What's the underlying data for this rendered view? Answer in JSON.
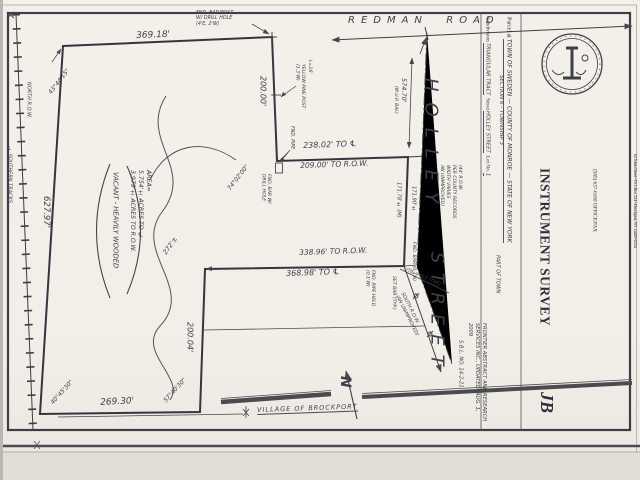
{
  "form": {
    "parcel_at_label": "Parcel at ",
    "municipality": "TOWN OF SWEDEN — COUNTY OF MONROE — STATE OF NEW YORK",
    "section_township": "SECTION 6 - TOWNSHIP 3",
    "subdivision_label": "Subdivision ",
    "subdivision": "TRIANGULAR TRACT",
    "street_label": "  Street ",
    "street": "HOLLEY STREET",
    "part_of_town": "PART OF TOWN",
    "lot_label": "  Lot No. ",
    "lot": "1",
    "abstract_note": "FRONTIER ABSTRACT AND RESEARCH\nSERVICES INC., UPDATED: AUG. 1,\n2009",
    "sbl_note": "S.B.L. NO. 14-2-21"
  },
  "title_block": {
    "firm": "A.J. BAREA-PLS",
    "profession": "Professional Land Surveyor",
    "address": "62 Main Street • P.O. Box 224 • Brockport, NY 14420-0224",
    "phone": "(585) 637-6180 OFFICE/FAX",
    "document_type": "INSTRUMENT SURVEY",
    "monogram": "JB"
  },
  "drawing": {
    "roads": {
      "redman_road": "REDMAN  ROAD",
      "holley_upper": "HOLLEY",
      "holley_lower": "STREET",
      "holley_row_note": "(44' R.O.W.\nPER COUNTY RECORDS\nWIDTH VARIES\nAN UNIMPROVED)",
      "holley_cl_dim": "574.70'",
      "holley_cl_dim_note": "(M.U.P. BAL)",
      "south_row_note": "SOUTH R.O.W.\n(AN UNIMPROVED)",
      "util_pole_note": "UTIL. POLE (TYP.)",
      "village_line": "VILLAGE OF BROCKPORT"
    },
    "railroad": {
      "centerline_label": "℄ SOUTHERN TRACKS",
      "row_label": "NORTH R.O.W."
    },
    "north_arrow": "N",
    "dimensions": {
      "north_line": "369.18'",
      "west_line": "627.97'",
      "east_line_1": "200.00'",
      "mid_line_cl": "238.02' TO ℄",
      "mid_line_row": "209.00' TO R.O.W.",
      "holley_west_row": "171.78'± (M)",
      "holley_cl": "171.90'±",
      "south_line_row": "338.96' TO R.O.W.",
      "south_line_cl": "368.98' TO ℄",
      "east_line_2": "200.04'",
      "south_line": "269.30'",
      "tie_272": "272'±"
    },
    "angles": {
      "nw": "43°44'15\"",
      "mid": "74°02'00\"",
      "sw": "40°45'30\"",
      "se": "57°40'30\""
    },
    "area": {
      "label": "AREA=",
      "to_cl": "5.754'± ACRES TO ℄",
      "to_row": "3.979'± ACRES TO R.O.W.",
      "condition": "VACANT - HEAVILY WOODED"
    },
    "monuments": {
      "ne_note": "FND. BAR/POST\nW/ DRILL HOLE\n(4'E, 2'W)",
      "yellow_pine": "YELLOW PINE POST\n(1.3'W)",
      "l16": "L=16'",
      "fnd_pipe": "FND. PIPE",
      "drill_hole": "FND. BAR W/\nDRILL HOLE",
      "fnd_bar": "FND. BAR (0.1'N)",
      "set_bar": "SET BAR (TYP.)",
      "pipe_held": "FND. PIPE HELD\n(0.1'W)"
    }
  }
}
